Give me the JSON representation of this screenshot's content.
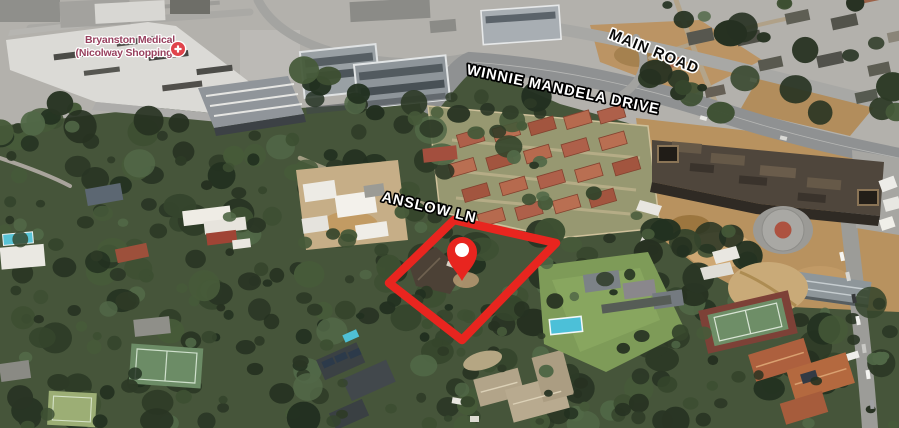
{
  "title": "Aerial 3D property map",
  "map": {
    "view_type": "3d-satellite-aerial",
    "road_labels": [
      {
        "id": "main-road",
        "text": "MAIN ROAD",
        "style": "black-text-white-halo"
      },
      {
        "id": "winnie-mandela-drive",
        "text": "WINNIE MANDELA DRIVE",
        "style": "white-text-black-halo"
      },
      {
        "id": "anslow-ln",
        "text": "ANSLOW LN",
        "style": "white-text-black-halo"
      }
    ],
    "poi_label": {
      "line1": "Bryanston Medical",
      "line2": "(Nicolway Shopping...",
      "icon": "medical-cross-pin",
      "text_color": "#98415f",
      "icon_color": "#e0434b",
      "icon_hole_color": "#ffffff"
    },
    "property_overlay": {
      "shape": "quadrilateral-boundary",
      "stroke_color": "#e8251f",
      "marker": "location-pin",
      "marker_color": "#e8251f",
      "marker_hole_color": "#ffffff"
    }
  }
}
